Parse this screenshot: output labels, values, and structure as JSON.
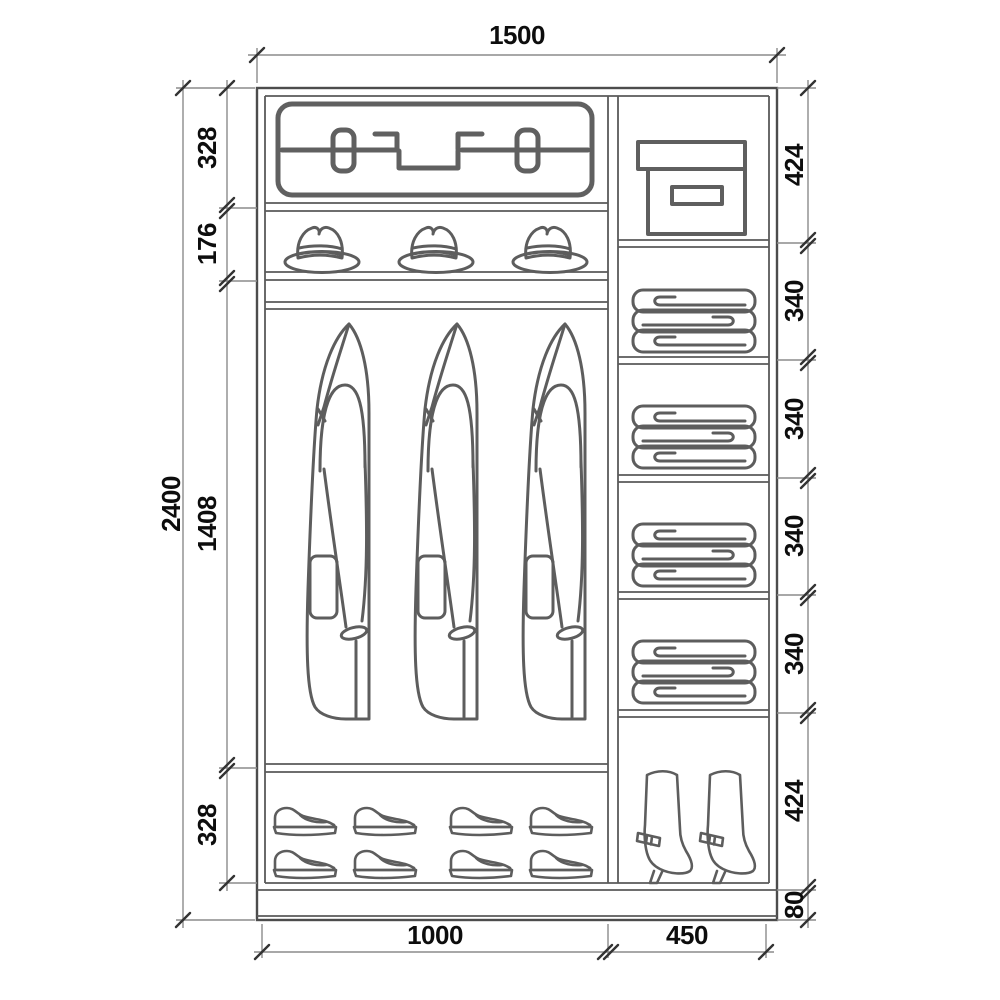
{
  "diagram": {
    "type": "wardrobe interior elevation with dimensions",
    "overall": {
      "width_label": "1500",
      "height_label": "2400"
    },
    "left_column": {
      "width_label": "1000",
      "sections_top_to_bottom": [
        "328",
        "176",
        "1408",
        "328"
      ],
      "contents": [
        "suitcase",
        "hats",
        "hanging coats",
        "shoes"
      ]
    },
    "right_column": {
      "width_label": "450",
      "sections_top_to_bottom": [
        "424",
        "340",
        "340",
        "340",
        "340",
        "424",
        "80"
      ],
      "contents": [
        "storage box",
        "folded linen",
        "folded linen",
        "folded linen",
        "folded linen",
        "boots",
        "plinth"
      ]
    },
    "icons": {
      "suitcase": "suitcase-icon",
      "hat": "hat-icon",
      "coat": "coat-icon",
      "shoe": "shoe-icon",
      "storage_box": "storage-box-icon",
      "linen_stack": "linen-stack-icon",
      "boot": "boot-icon"
    },
    "colors": {
      "background": "#ffffff",
      "structure_line": "#4c4c4c",
      "icon_line": "#5d5d5d",
      "dimension_line": "#8c8c8c",
      "tick": "#333333",
      "text": "#0d0d0d"
    }
  }
}
